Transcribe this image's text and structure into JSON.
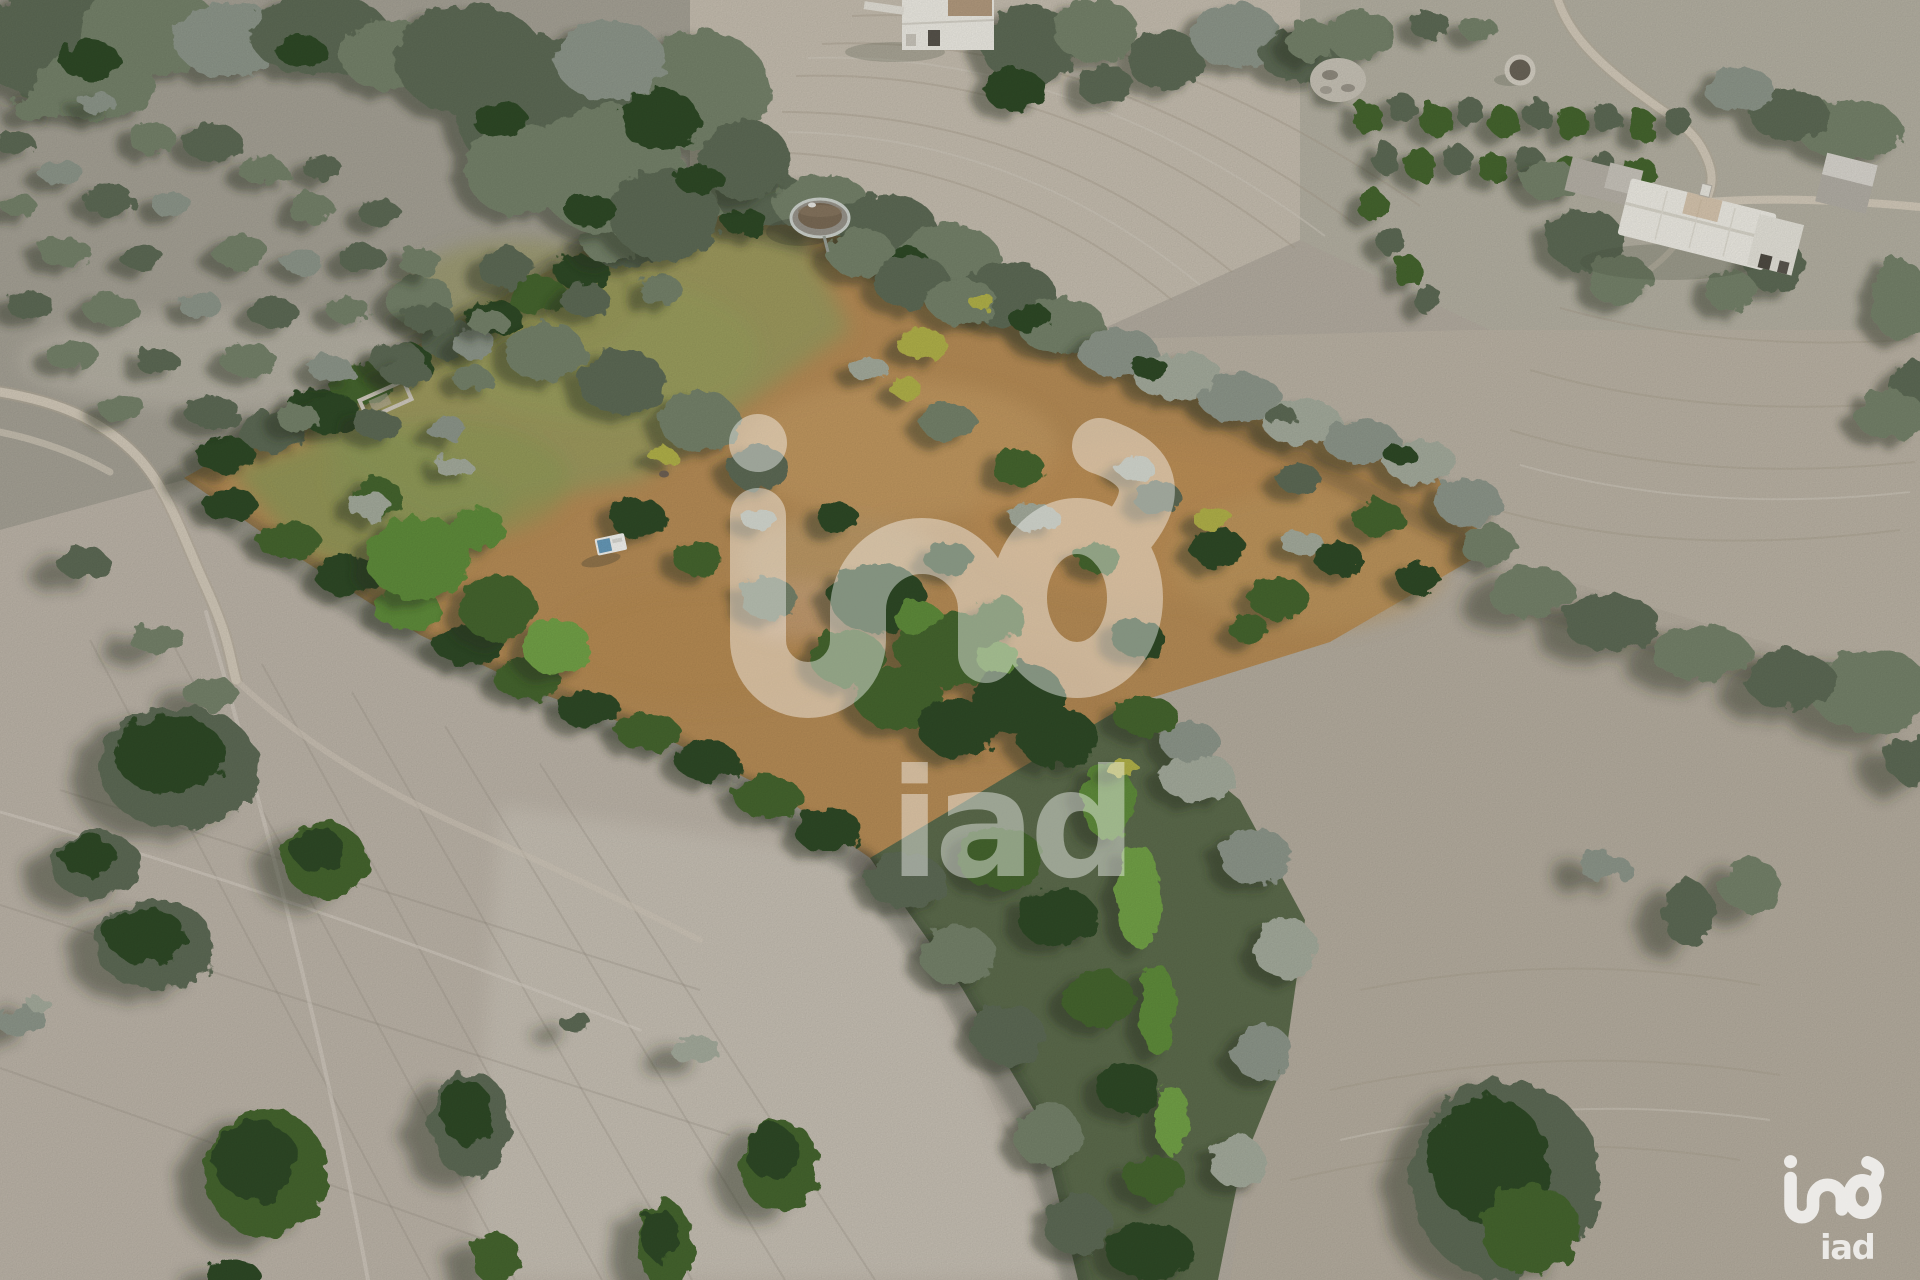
{
  "image": {
    "kind": "aerial drone photograph",
    "subject": "rural land parcel bordered by tree hedges, surrounded by dry pale fields with scattered oak and olive trees, a farmhouse at top right, a round water tank at the top of the parcel",
    "width_px": 1920,
    "height_px": 1280
  },
  "watermark": {
    "brand": "iad",
    "center_text": "iad",
    "corner_text": "iad",
    "color": "#ffffff",
    "center_opacity": 0.42,
    "corner_opacity": 0.78
  },
  "features": [
    "land-parcel",
    "tree-hedges",
    "tree-corridor",
    "dirt-roads",
    "water-tank",
    "stone-tank",
    "farmhouse",
    "white-farm-building",
    "orchard-rows",
    "dry-fields",
    "field-tracks",
    "caravan",
    "stone-ruin"
  ],
  "palette": {
    "dry_field": "#b3aca0",
    "bright_field": "#c8c1b5",
    "gray_green_field": "#a5a195",
    "parcel_dry_grass": "#b68c56",
    "parcel_green_grass": "#8f9557",
    "tree_dark_green": "#2e4a26",
    "tree_bright_green": "#5f8c3a",
    "tree_gray_green": "#75826a",
    "tree_silver": "#a4ab9c",
    "shrub_yellow": "#b1b14a",
    "dirt_road": "#d2c9b9",
    "farmhouse_white": "#edebe3",
    "water_tank_rim": "#cdd2cc",
    "water_tank_inside": "#7a6a55",
    "watermark_white": "#ffffff"
  }
}
